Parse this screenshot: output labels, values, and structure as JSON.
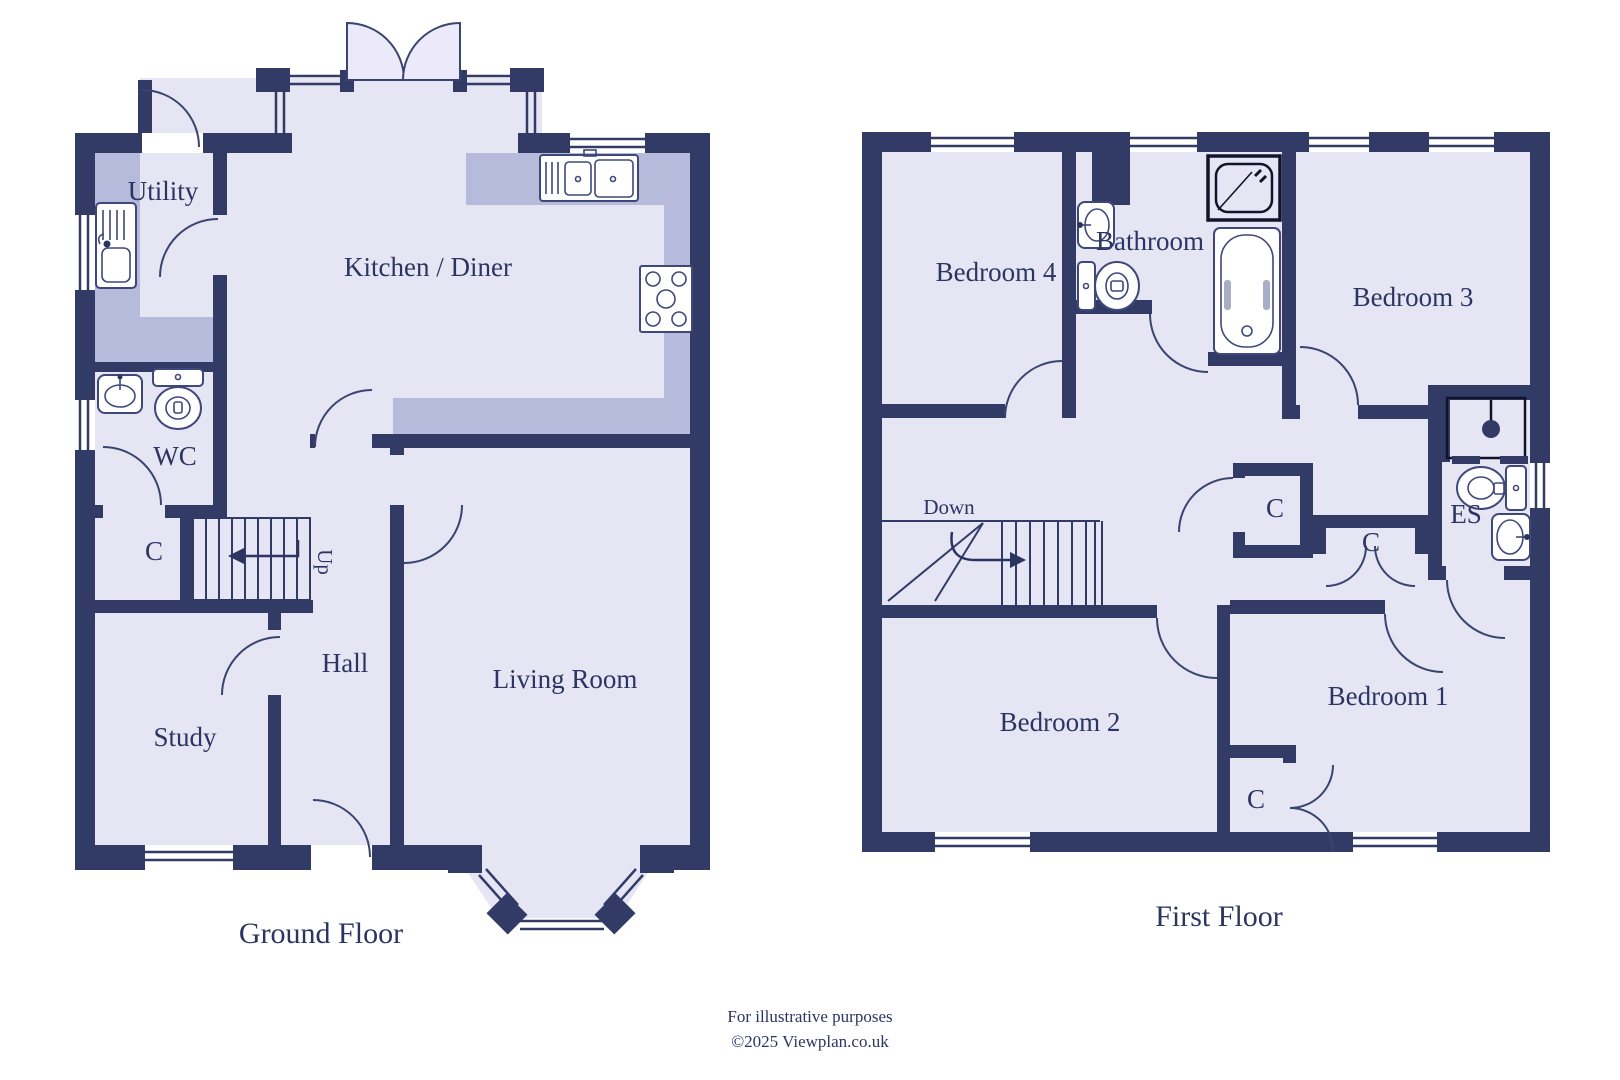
{
  "colors": {
    "wall": "#323b66",
    "floor_fill": "#e5e5f4",
    "counter_fill": "#b6bbdb",
    "text": "#2c3561",
    "background": "#ffffff"
  },
  "ground_floor": {
    "title": "Ground Floor",
    "rooms": {
      "utility": "Utility",
      "kitchen": "Kitchen / Diner",
      "wc": "WC",
      "cupboard": "C",
      "hall": "Hall",
      "study": "Study",
      "living": "Living Room"
    },
    "stairs_label": "Up"
  },
  "first_floor": {
    "title": "First Floor",
    "rooms": {
      "bedroom4": "Bedroom 4",
      "bathroom": "Bathroom",
      "bedroom3": "Bedroom 3",
      "bedroom2": "Bedroom 2",
      "bedroom1": "Bedroom 1",
      "ensuite": "ES",
      "cupboard_landing": "C",
      "cupboard_middle": "C",
      "cupboard_bedroom1": "C"
    },
    "stairs_label": "Down"
  },
  "footer": {
    "line1": "For illustrative purposes",
    "line2": "©2025 Viewplan.co.uk"
  }
}
